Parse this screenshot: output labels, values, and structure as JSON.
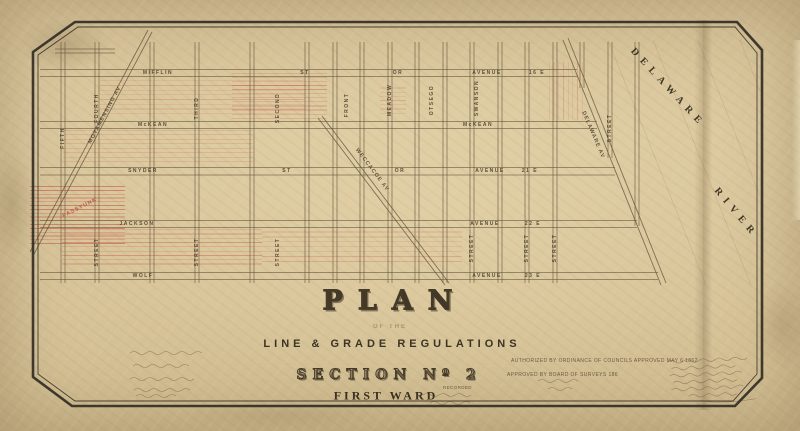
{
  "title_block": {
    "title": "PLAN",
    "of_the": "OF THE",
    "subject": "LINE & GRADE REGULATIONS",
    "section": "SECTION Nº 2",
    "ward": "FIRST WARD"
  },
  "river": {
    "word1": "DELAWARE",
    "word2": "RIVER"
  },
  "approvals": {
    "line1": "AUTHORIZED BY ORDINANCE OF COUNCILS APPROVED MAY 6 1862",
    "line2": "APPROVED BY BOARD OF SURVEYS 186",
    "recorded": "RECORDED"
  },
  "streets": {
    "horizontal": [
      "MIFFLIN",
      "ST",
      "OR",
      "AVENUE",
      "16 E",
      "McKEAN",
      "McKEAN",
      "SNYDER",
      "ST",
      "OR",
      "AVENUE",
      "21 E",
      "JACKSON",
      "AVENUE",
      "22 E",
      "WOLF",
      "AVENUE",
      "23 E"
    ],
    "vertical": [
      "FIFTH",
      "FOURTH",
      "THIRD",
      "SECOND",
      "FRONT",
      "MEADOW",
      "OTSEGO",
      "SWANSON",
      "STREET",
      "STREET",
      "STREET",
      "STREET",
      "STREET",
      "STREET",
      "STREET"
    ],
    "diagonal": [
      "MOYAMENSING AV",
      "WECCACOE AV",
      "DELAWARE AV"
    ],
    "red_note": "PASSYUNK"
  },
  "colors": {
    "paper": "#d8c49a",
    "ink": "#4a3e2c",
    "red": "#c0504a"
  }
}
